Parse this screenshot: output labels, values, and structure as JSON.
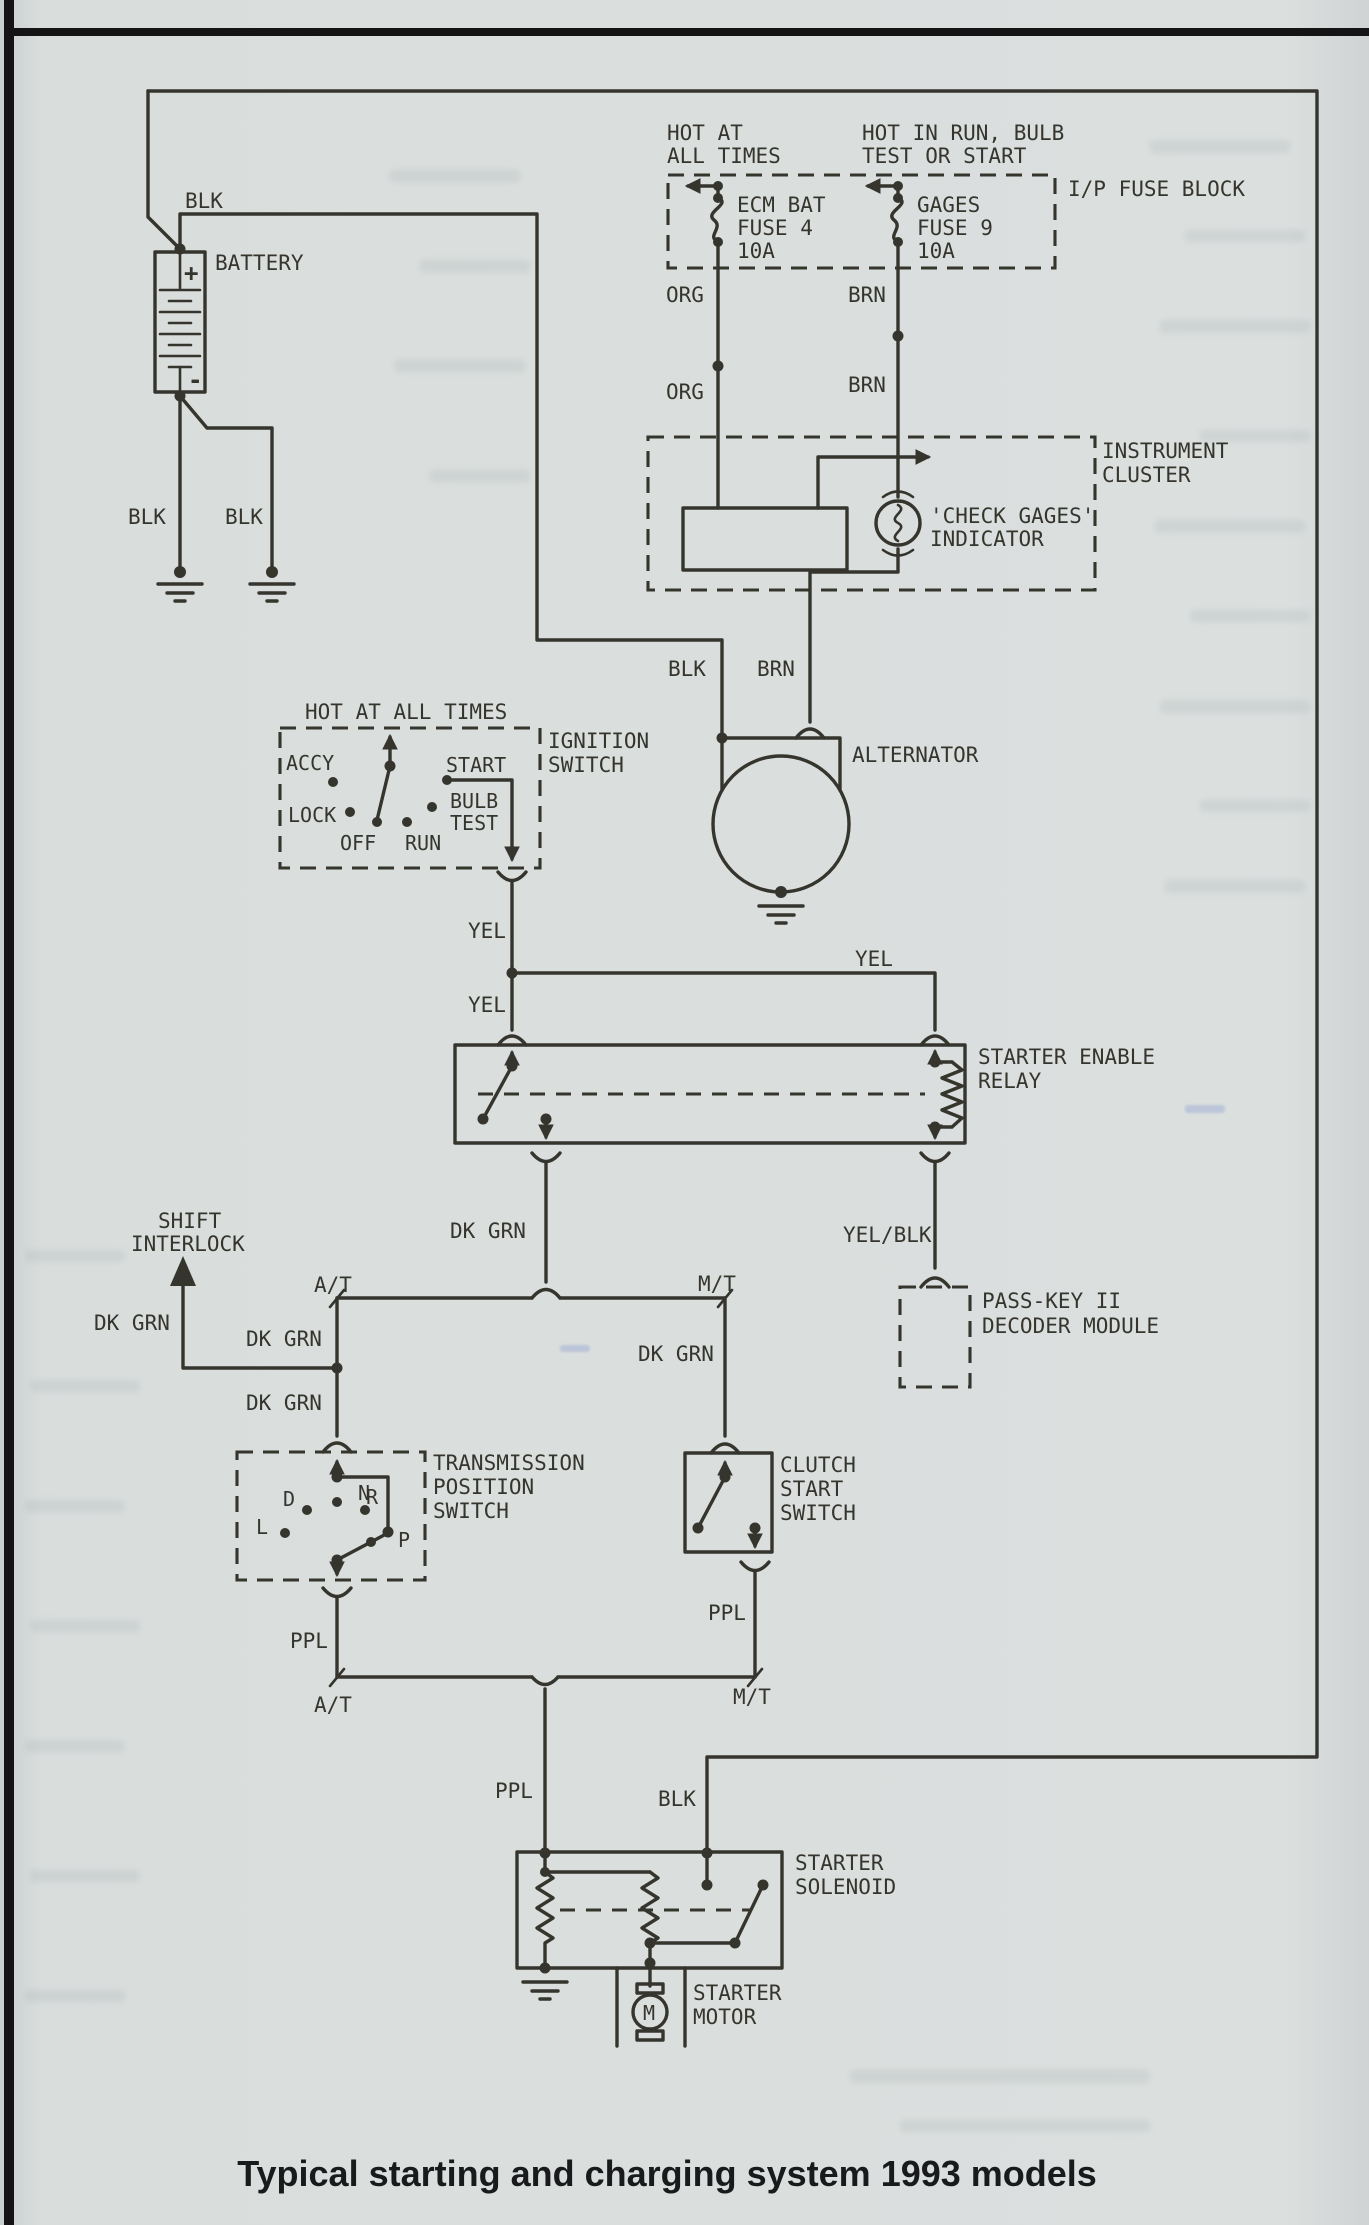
{
  "page": {
    "caption": "Typical starting and charging system 1993 models",
    "paper_color": "#dbdfde",
    "ink_color": "#35352e"
  },
  "wires": {
    "blk": "BLK",
    "org": "ORG",
    "brn": "BRN",
    "yel": "YEL",
    "yel_blk": "YEL/BLK",
    "dk_grn": "DK GRN",
    "ppl": "PPL",
    "at": "A/T",
    "mt": "M/T"
  },
  "fuse_block": {
    "title": "I/P FUSE BLOCK",
    "hot_left_1": "HOT AT",
    "hot_left_2": "ALL TIMES",
    "hot_right_1": "HOT IN RUN, BULB",
    "hot_right_2": "TEST OR START",
    "fuse4": {
      "line1": "ECM BAT",
      "line2": "FUSE 4",
      "line3": "10A"
    },
    "fuse9": {
      "line1": "GAGES",
      "line2": "FUSE 9",
      "line3": "10A"
    }
  },
  "battery": {
    "label": "BATTERY",
    "plus": "+",
    "minus": "-"
  },
  "instrument_cluster": {
    "title_1": "INSTRUMENT",
    "title_2": "CLUSTER",
    "indicator_1": "'CHECK GAGES'",
    "indicator_2": "INDICATOR"
  },
  "ignition_switch": {
    "header": "HOT AT ALL TIMES",
    "title_1": "IGNITION",
    "title_2": "SWITCH",
    "pos_accy": "ACCY",
    "pos_lock": "LOCK",
    "pos_off": "OFF",
    "pos_run": "RUN",
    "pos_bulb_1": "BULB",
    "pos_bulb_2": "TEST",
    "pos_start": "START"
  },
  "alternator": {
    "label": "ALTERNATOR"
  },
  "starter_relay": {
    "title_1": "STARTER ENABLE",
    "title_2": "RELAY"
  },
  "passkey": {
    "title_1": "PASS-KEY II",
    "title_2": "DECODER MODULE"
  },
  "shift_interlock": {
    "label_1": "SHIFT",
    "label_2": "INTERLOCK"
  },
  "transmission_switch": {
    "title_1": "TRANSMISSION",
    "title_2": "POSITION",
    "title_3": "SWITCH",
    "pos_l": "L",
    "pos_d": "D",
    "pos_n": "N",
    "pos_r": "R",
    "pos_p": "P"
  },
  "clutch_switch": {
    "title_1": "CLUTCH",
    "title_2": "START",
    "title_3": "SWITCH"
  },
  "starter_solenoid": {
    "title_1": "STARTER",
    "title_2": "SOLENOID"
  },
  "starter_motor": {
    "title_1": "STARTER",
    "title_2": "MOTOR",
    "symbol": "M"
  }
}
